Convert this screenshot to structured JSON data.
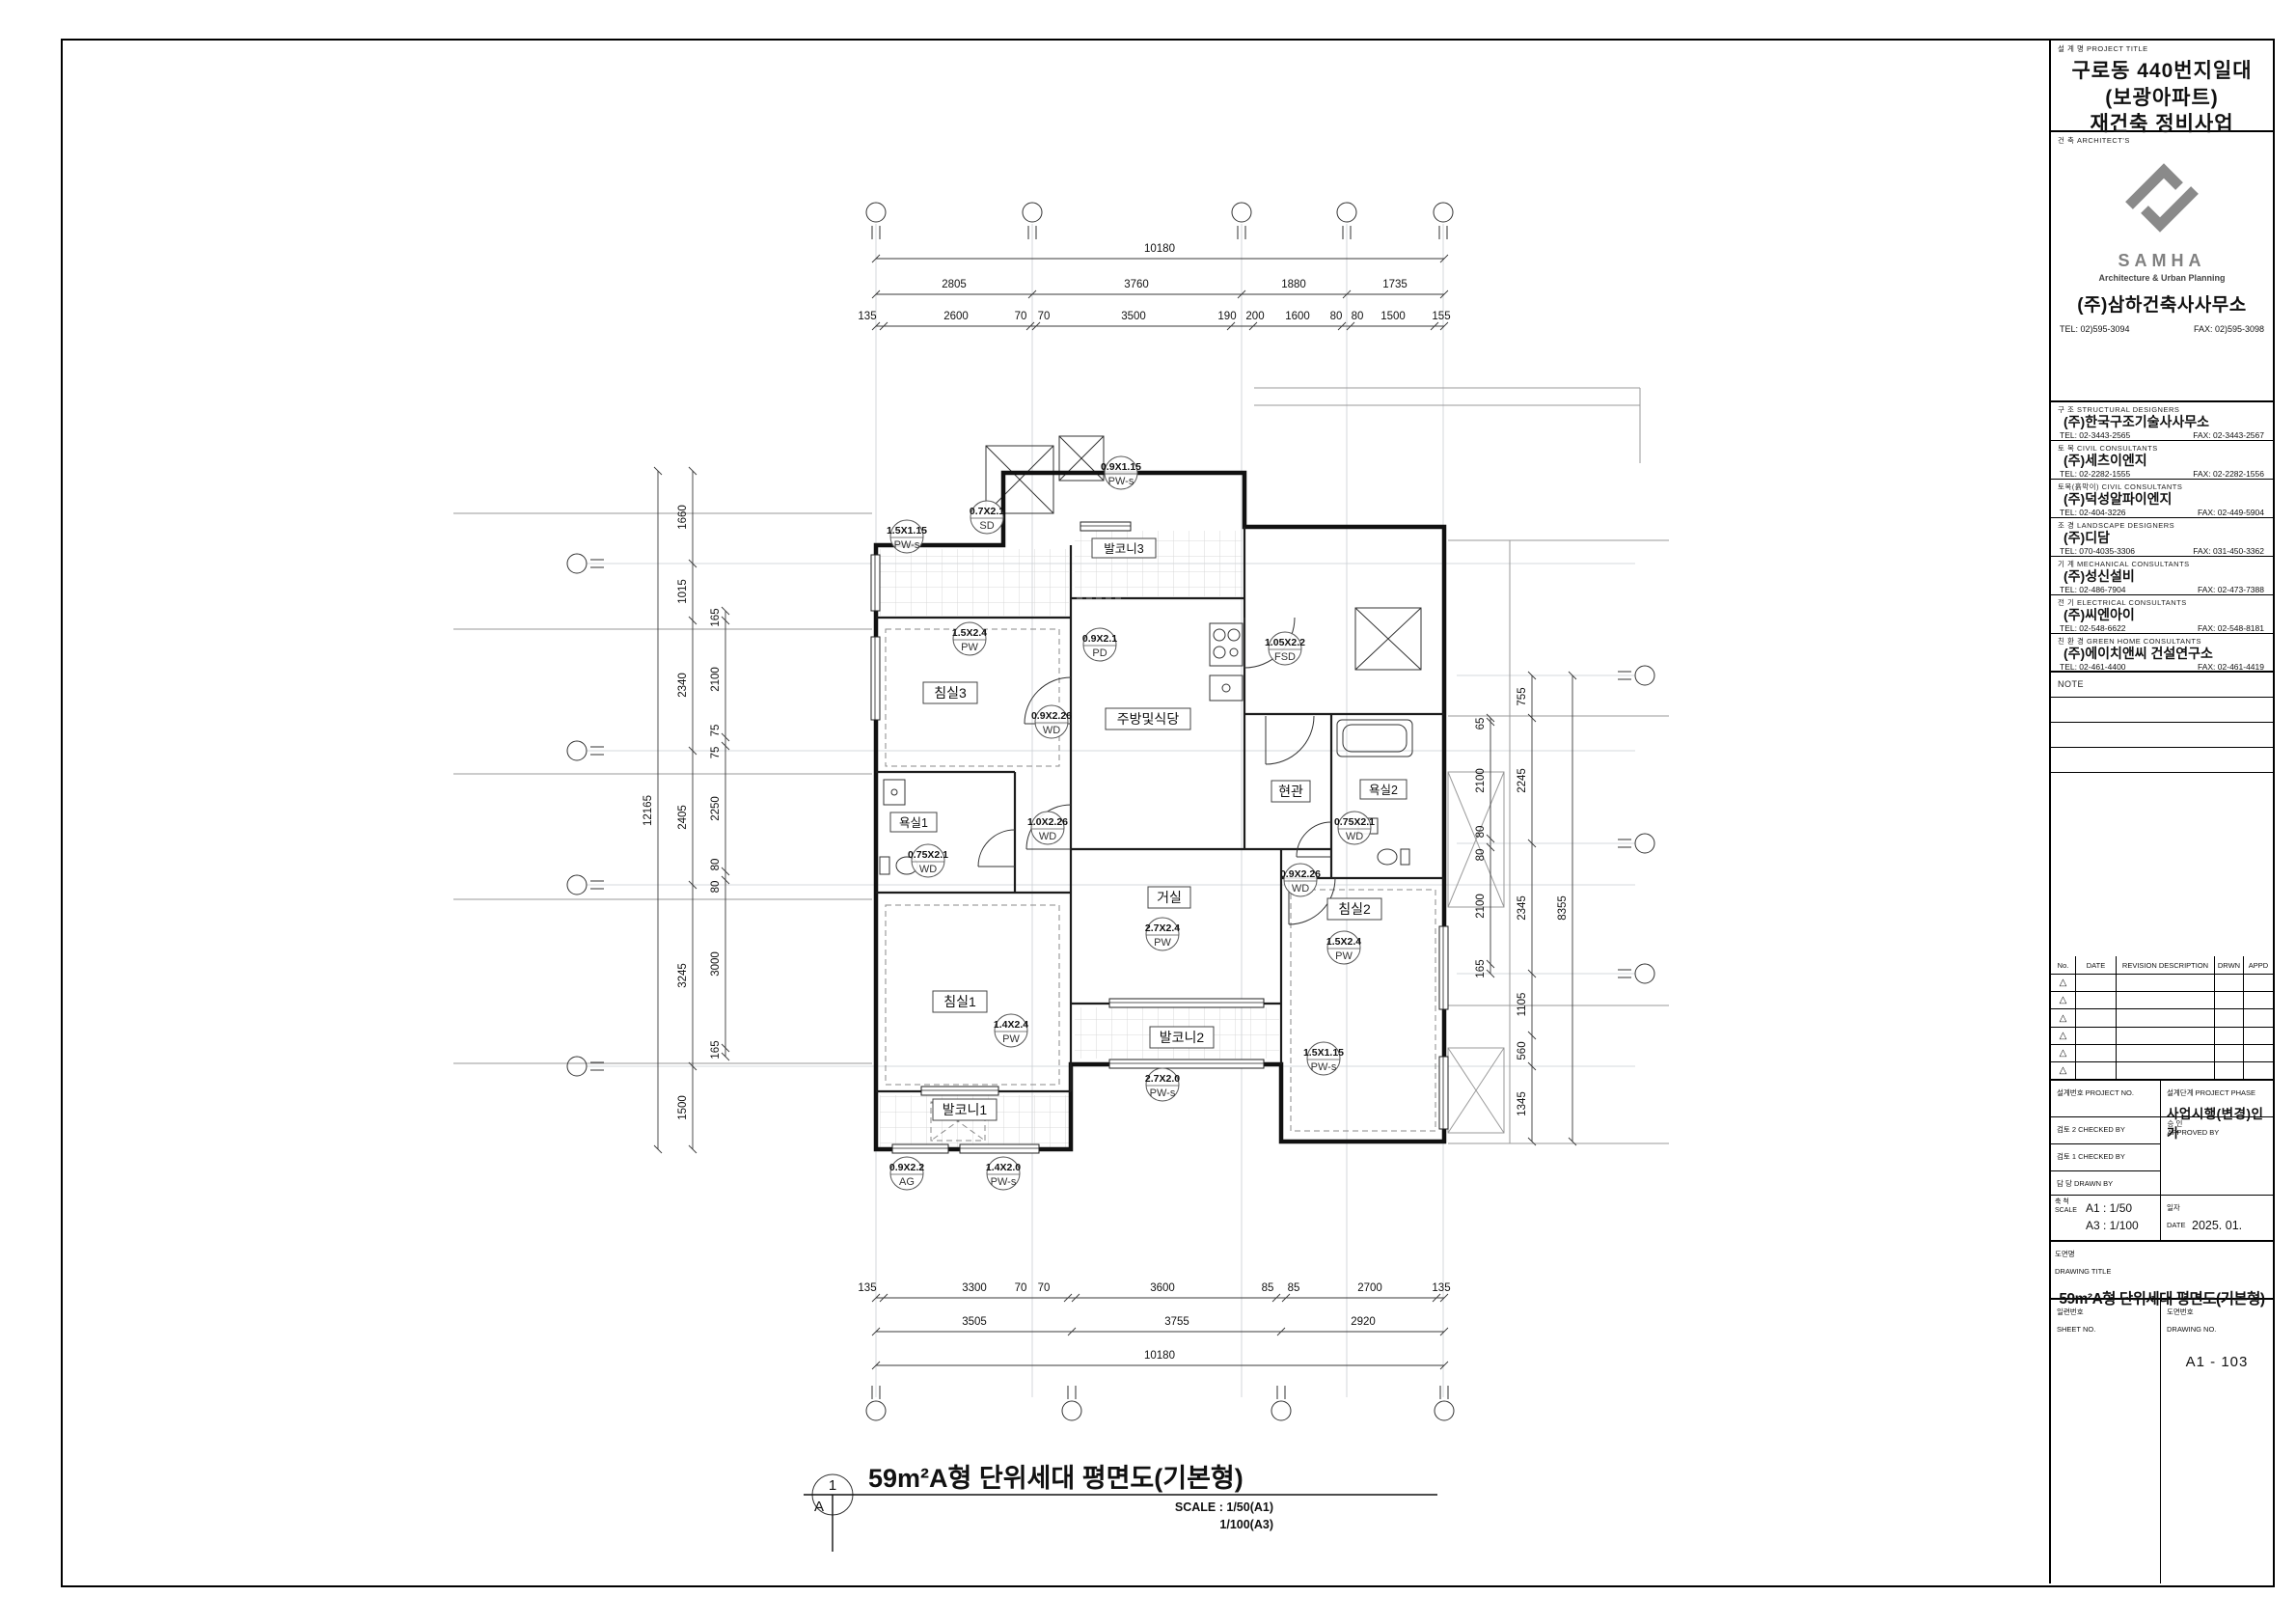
{
  "title_block": {
    "project_title_label": "설 계 명  PROJECT TITLE",
    "project_title_lines": [
      "구로동 440번지일대",
      "(보광아파트)",
      "재건축 정비사업"
    ],
    "architects_label": "건    축  ARCHITECT'S",
    "architect": {
      "logo_text": "SAMHA",
      "tagline": "Architecture & Urban Planning",
      "name": "(주)삼하건축사사무소",
      "tel": "TEL:  02)595-3094",
      "fax": "FAX:  02)595-3098"
    },
    "consultants": [
      {
        "label": "구    조  STRUCTURAL DESIGNERS",
        "name": "(주)한국구조기술사사무소",
        "tel": "TEL:  02-3443-2565",
        "fax": "FAX:  02-3443-2567"
      },
      {
        "label": "토    목  CIVIL CONSULTANTS",
        "name": "(주)세츠이엔지",
        "tel": "TEL:  02-2282-1555",
        "fax": "FAX:  02-2282-1556"
      },
      {
        "label": "토목(흙막이)  CIVIL CONSULTANTS",
        "name": "(주)덕성알파이엔지",
        "tel": "TEL:  02-404-3226",
        "fax": "FAX:  02-449-5904"
      },
      {
        "label": "조    경  LANDSCAPE DESIGNERS",
        "name": "(주)디담",
        "tel": "TEL:  070-4035-3306",
        "fax": "FAX:  031-450-3362"
      },
      {
        "label": "기    계  MECHANICAL CONSULTANTS",
        "name": "(주)성신설비",
        "tel": "TEL:  02-486-7904",
        "fax": "FAX:  02-473-7388"
      },
      {
        "label": "전    기  ELECTRICAL CONSULTANTS",
        "name": "(주)씨엔아이",
        "tel": "TEL:  02-548-6622",
        "fax": "FAX:  02-548-8181"
      },
      {
        "label": "친 환 경  GREEN HOME CONSULTANTS",
        "name": "(주)에이치앤씨 건설연구소",
        "tel": "TEL:  02-461-4400",
        "fax": "FAX:  02-461-4419"
      }
    ],
    "note_label": "NOTE",
    "revision": {
      "cols": [
        "No.",
        "DATE",
        "REVISION DESCRIPTION",
        "DRWN",
        "APPD"
      ],
      "marker": "△"
    },
    "project_no_label": "설계번호 PROJECT NO.",
    "project_phase_label": "설계단계 PROJECT PHASE",
    "project_phase": "사업시행(변경)인가",
    "checked2_label": "검토 2 CHECKED BY",
    "checked1_label": "검토 1 CHECKED BY",
    "approved_label_kr": "승    인",
    "approved_label_en": "APPROVED BY",
    "drawn_label": "담    당 DRAWN BY",
    "scale_label_kr": "축  척",
    "scale_label_en": "SCALE",
    "scale_a1": "A1 :   1/50",
    "scale_a3": "A3 :   1/100",
    "date_label_kr": "일자",
    "date_label_en": "DATE",
    "date_value": "2025. 01.",
    "drawing_title_label_kr": "도면명",
    "drawing_title_label_en": "DRAWING TITLE",
    "drawing_title": "59m²A형 단위세대 평면도(기본형)",
    "sheet_no_label_kr": "일련번호",
    "sheet_no_label_en": "SHEET NO.",
    "drawing_no_label_kr": "도면번호",
    "drawing_no_label_en": "DRAWING NO.",
    "drawing_no": "A1 - 103"
  },
  "drawing": {
    "caption": {
      "number": "1",
      "letter": "A",
      "title": "59m²A형 단위세대 평면도(기본형)",
      "scale_line1": "SCALE : 1/50(A1)",
      "scale_line2": "1/100(A3)"
    },
    "rooms": [
      "침실3",
      "주방및식당",
      "거실",
      "침실1",
      "욕실1",
      "현관",
      "욕실2",
      "침실2",
      "발코니1",
      "발코니2",
      "발코니3"
    ],
    "tags": [
      {
        "size": "1.5X1.15",
        "type": "PW-s"
      },
      {
        "size": "0.7X2.1",
        "type": "SD"
      },
      {
        "size": "0.9X1.15",
        "type": "PW-s"
      },
      {
        "size": "1.5X2.4",
        "type": "PW"
      },
      {
        "size": "0.9X2.1",
        "type": "PD"
      },
      {
        "size": "1.05X2.2",
        "type": "FSD"
      },
      {
        "size": "0.9X2.26",
        "type": "WD"
      },
      {
        "size": "0.75X2.1",
        "type": "WD"
      },
      {
        "size": "1.0X2.26",
        "type": "WD"
      },
      {
        "size": "0.75X2.1",
        "type": "WD"
      },
      {
        "size": "0.9X2.26",
        "type": "WD"
      },
      {
        "size": "2.7X2.4",
        "type": "PW"
      },
      {
        "size": "1.5X2.4",
        "type": "PW"
      },
      {
        "size": "1.4X2.4",
        "type": "PW"
      },
      {
        "size": "1.5X1.15",
        "type": "PW-s"
      },
      {
        "size": "2.7X2.0",
        "type": "PW-s"
      },
      {
        "size": "1.4X2.0",
        "type": "PW-s"
      },
      {
        "size": "0.9X2.2",
        "type": "AG"
      }
    ],
    "dims": {
      "top_total": "10180",
      "top_mid": [
        "2805",
        "3760",
        "1880",
        "1735"
      ],
      "top_fine": [
        "135",
        "2600",
        "70",
        "70",
        "3500",
        "190",
        "200",
        "1600",
        "80",
        "80",
        "1500",
        "155"
      ],
      "bottom_fine": [
        "135",
        "3300",
        "70",
        "70",
        "3600",
        "85",
        "85",
        "2700",
        "135"
      ],
      "bottom_mid": [
        "3505",
        "3755",
        "2920"
      ],
      "bottom_total": "10180",
      "left_total": "12165",
      "left_outer": [
        "1660",
        "1015",
        "2340",
        "2405",
        "3245",
        "1500"
      ],
      "left_inner": [
        "165",
        "2100",
        "75",
        "75",
        "2250",
        "80",
        "80",
        "3000",
        "165"
      ],
      "right_inner": [
        "65",
        "2100",
        "80",
        "80",
        "2100",
        "165"
      ],
      "right_mid": [
        "755",
        "2245",
        "2345",
        "1105",
        "560",
        "1345"
      ],
      "right_total": "8355"
    }
  }
}
